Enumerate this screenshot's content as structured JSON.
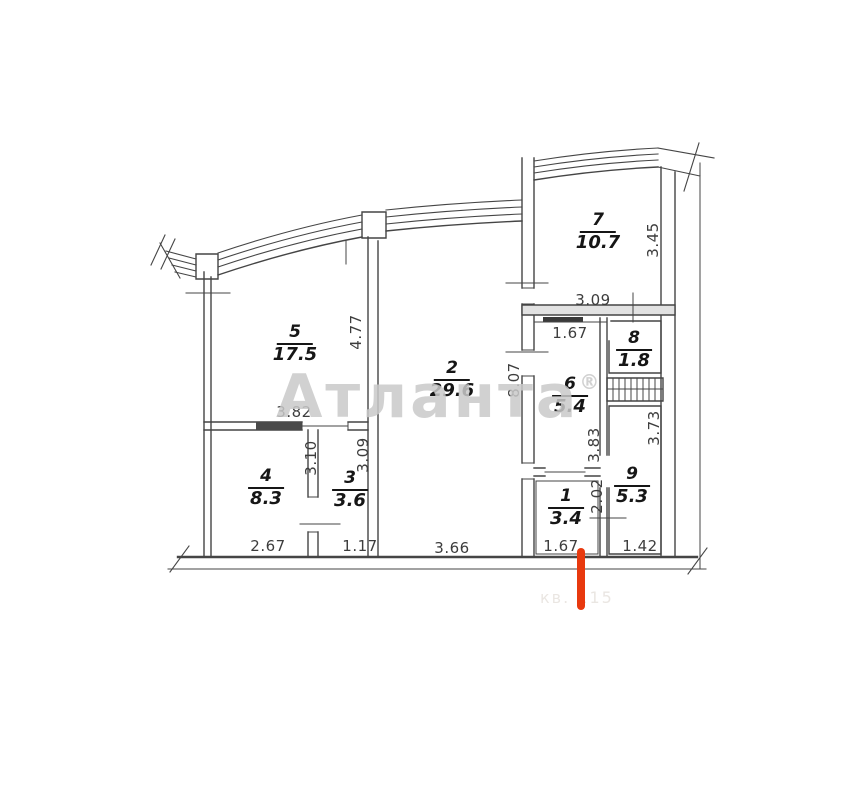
{
  "plan": {
    "watermark": {
      "text": "Атланта",
      "registered_mark": "®"
    },
    "faint_stamp": "кв. 115",
    "colors": {
      "wall_line": "#454545",
      "dimension_text": "#3d3d3d",
      "room_text": "#161616",
      "watermark_gray": "#c9c9c9",
      "entrance_marker_red": "#e8390e"
    },
    "rooms": {
      "r1": {
        "number": "1",
        "area": "3.4"
      },
      "r2": {
        "number": "2",
        "area": "29.6"
      },
      "r3": {
        "number": "3",
        "area": "3.6"
      },
      "r4": {
        "number": "4",
        "area": "8.3"
      },
      "r5": {
        "number": "5",
        "area": "17.5"
      },
      "r6": {
        "number": "6",
        "area": "5.4"
      },
      "r7": {
        "number": "7",
        "area": "10.7"
      },
      "r8": {
        "number": "8",
        "area": "1.8"
      },
      "r9": {
        "number": "9",
        "area": "5.3"
      }
    },
    "dims": {
      "room5_width": "3.82",
      "room5_height": "4.77",
      "room2_width": "3.66",
      "room2_height": "8.07",
      "room7_width": "3.09",
      "room7_height": "3.45",
      "room6_top_width": "1.67",
      "room6_height": "3.83",
      "room9_height": "3.73",
      "room9_width": "1.42",
      "hall_height": "2.02",
      "hall_width": "1.67",
      "room4_height": "3.10",
      "room4_width": "2.67",
      "room3_height": "3.09",
      "room3_width": "1.17"
    }
  }
}
